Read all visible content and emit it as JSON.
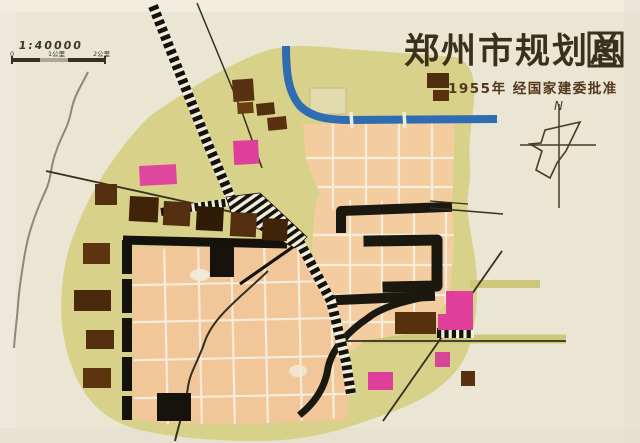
{
  "map": {
    "title_main": "郑州市规划总",
    "title_boxed": "图",
    "subtitle": "1955年 经国家建委批准",
    "scale": {
      "ratio": "1:40000",
      "t0": "0",
      "t1": "1公里",
      "t2": "2公里"
    },
    "compass_label": "N",
    "colors": {
      "paper": "#ebe5d4",
      "olive": "#d7d189",
      "peach": "#f3cda0",
      "grid_line": "#f7f0df",
      "river_blue": "#2f6cb2",
      "river_grey": "#8a8a78",
      "rail_black": "#14120b",
      "built_black": "#1b1810",
      "industry_brown": "#55300f",
      "special_magenta": "#df3f9b",
      "title_ink": "#3b301c"
    },
    "blocks": {
      "brown": [
        {
          "x": 232,
          "y": 80,
          "w": 21,
          "h": 22,
          "c": "#5a3110",
          "r": -4
        },
        {
          "x": 237,
          "y": 103,
          "w": 16,
          "h": 11,
          "c": "#6b3d12",
          "r": -4
        },
        {
          "x": 256,
          "y": 104,
          "w": 18,
          "h": 12,
          "c": "#52300e",
          "r": -6
        },
        {
          "x": 267,
          "y": 118,
          "w": 19,
          "h": 13,
          "c": "#5a3110",
          "r": -6
        },
        {
          "x": 427,
          "y": 73,
          "w": 22,
          "h": 15,
          "c": "#4f2e0e",
          "r": 0
        },
        {
          "x": 433,
          "y": 90,
          "w": 16,
          "h": 11,
          "c": "#5a3110",
          "r": 0
        },
        {
          "x": 95,
          "y": 184,
          "w": 22,
          "h": 21,
          "c": "#542f0f",
          "r": 0
        },
        {
          "x": 83,
          "y": 243,
          "w": 27,
          "h": 21,
          "c": "#5c3410",
          "r": 0
        },
        {
          "x": 74,
          "y": 290,
          "w": 37,
          "h": 21,
          "c": "#4a2a0c",
          "r": 0
        },
        {
          "x": 86,
          "y": 330,
          "w": 28,
          "h": 19,
          "c": "#542f0f",
          "r": 0
        },
        {
          "x": 83,
          "y": 368,
          "w": 28,
          "h": 20,
          "c": "#5c3410",
          "r": 0
        },
        {
          "x": 130,
          "y": 196,
          "w": 29,
          "h": 25,
          "c": "#3f240a",
          "r": 3
        },
        {
          "x": 164,
          "y": 201,
          "w": 27,
          "h": 24,
          "c": "#542f0f",
          "r": 3
        },
        {
          "x": 197,
          "y": 206,
          "w": 27,
          "h": 24,
          "c": "#301c06",
          "r": 3
        },
        {
          "x": 231,
          "y": 212,
          "w": 26,
          "h": 24,
          "c": "#542f0f",
          "r": 3
        },
        {
          "x": 263,
          "y": 218,
          "w": 25,
          "h": 22,
          "c": "#3f240a",
          "r": 3
        },
        {
          "x": 395,
          "y": 312,
          "w": 41,
          "h": 22,
          "c": "#57300d",
          "r": 0
        },
        {
          "x": 461,
          "y": 371,
          "w": 14,
          "h": 15,
          "c": "#5a3110",
          "r": 0
        }
      ],
      "magenta": [
        {
          "x": 233,
          "y": 141,
          "w": 25,
          "h": 24,
          "c": "#df3f9b",
          "r": -3
        },
        {
          "x": 139,
          "y": 166,
          "w": 37,
          "h": 20,
          "c": "#e0489f",
          "r": -3
        },
        {
          "x": 446,
          "y": 291,
          "w": 27,
          "h": 39,
          "c": "#df3f9b",
          "r": 0
        },
        {
          "x": 438,
          "y": 314,
          "w": 10,
          "h": 16,
          "c": "#df3f9b",
          "r": 0
        },
        {
          "x": 435,
          "y": 352,
          "w": 15,
          "h": 15,
          "c": "#d84496",
          "r": 0
        },
        {
          "x": 368,
          "y": 372,
          "w": 25,
          "h": 18,
          "c": "#df3f9b",
          "r": 0
        }
      ],
      "black": [
        {
          "x": 210,
          "y": 243,
          "w": 24,
          "h": 34,
          "c": "#15130c",
          "r": 0
        },
        {
          "x": 157,
          "y": 393,
          "w": 34,
          "h": 28,
          "c": "#15130c",
          "r": 0
        }
      ]
    }
  }
}
